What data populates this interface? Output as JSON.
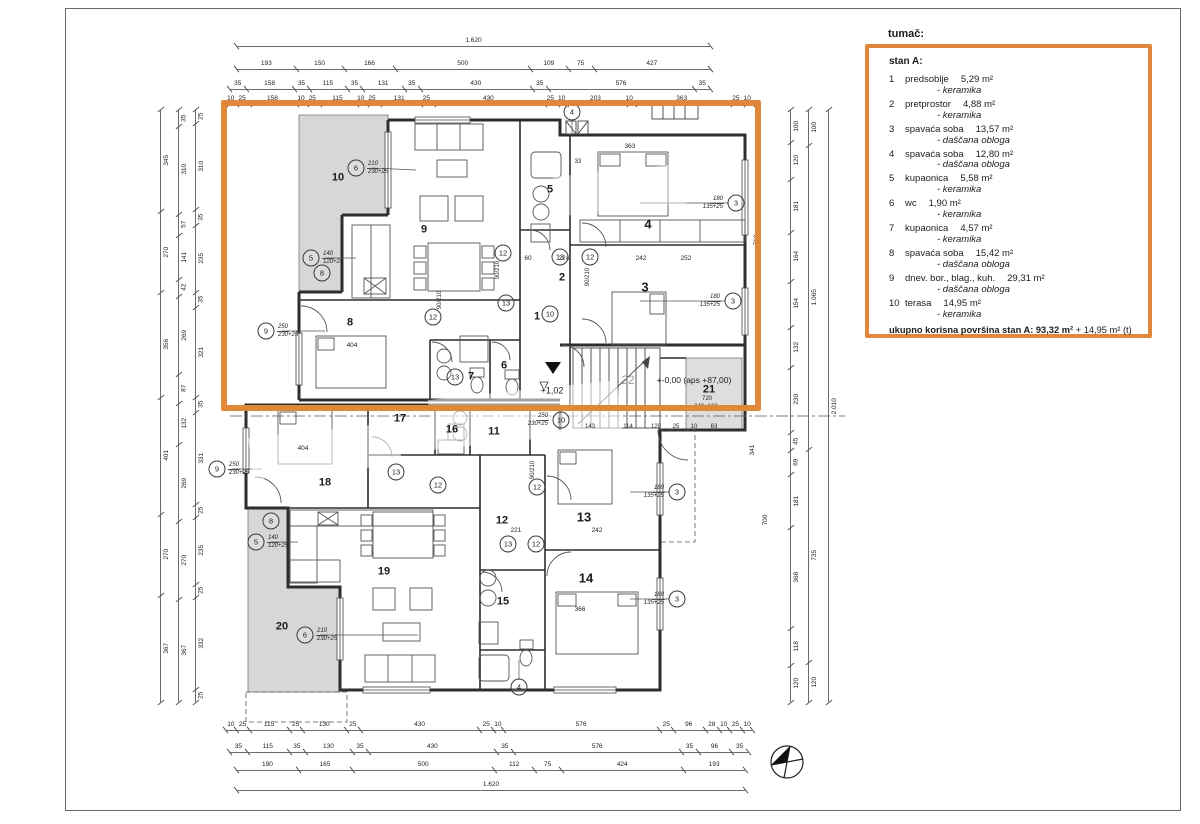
{
  "legend": {
    "title": "tumač:",
    "apartment": "stan A:",
    "items": [
      {
        "num": "1",
        "name": "predsoblje",
        "area": "5,29 m²",
        "material": "- keramika"
      },
      {
        "num": "2",
        "name": "pretprostor",
        "area": "4,88 m²",
        "material": "- keramika"
      },
      {
        "num": "3",
        "name": "spavaća soba",
        "area": "13,57 m²",
        "material": "- daščana obloga"
      },
      {
        "num": "4",
        "name": "spavaća soba",
        "area": "12,80 m²",
        "material": "- daščana obloga"
      },
      {
        "num": "5",
        "name": "kupaonica",
        "area": "5,58 m²",
        "material": "- keramika"
      },
      {
        "num": "6",
        "name": "wc",
        "area": "1,90 m²",
        "material": "- keramika"
      },
      {
        "num": "7",
        "name": "kupaonica",
        "area": "4,57 m²",
        "material": "- keramika"
      },
      {
        "num": "8",
        "name": "spavaća soba",
        "area": "15,42 m²",
        "material": "- daščana obloga"
      },
      {
        "num": "9",
        "name": "dnev. bor., blag., kuh.",
        "area": "29,31 m²",
        "material": "- daščana obloga"
      },
      {
        "num": "10",
        "name": "terasa",
        "area": "14,95 m²",
        "material": "- keramika"
      }
    ],
    "total_bold": "ukupno korisna površina stan A: 93,32 m²",
    "total_rest": " + 14,95 m² (t)"
  },
  "colors": {
    "highlight": "#e0873c",
    "wall": "#2e2e2e",
    "terrace_fill": "#d7d7d7"
  },
  "plan": {
    "dims": {
      "top1": [
        "1.620"
      ],
      "top2": [
        "193",
        "150",
        "166",
        "500",
        "109",
        "75",
        "427"
      ],
      "top3": [
        "35",
        "158",
        "35",
        "115",
        "35",
        "131",
        "35",
        "430",
        "35",
        "576",
        "35"
      ],
      "top4": [
        "10",
        "25",
        "158",
        "10",
        "25",
        "115",
        "10",
        "25",
        "131",
        "25",
        "430",
        "25",
        "10",
        "203",
        "10",
        "363",
        "25",
        "10"
      ],
      "bottom1": [
        "10",
        "25",
        "115",
        "25",
        "130",
        "25",
        "430",
        "25",
        "10",
        "576",
        "25",
        "96",
        "28",
        "10",
        "25",
        "10"
      ],
      "bottom2": [
        "35",
        "115",
        "35",
        "130",
        "35",
        "430",
        "35",
        "576",
        "35",
        "96",
        "35"
      ],
      "bottom3": [
        "190",
        "165",
        "500",
        "112",
        "75",
        "424",
        "193"
      ],
      "bottom4": [
        "1.620"
      ],
      "left1": [
        "345",
        "270",
        "356",
        "401",
        "270",
        "367"
      ],
      "left2": [
        "35",
        "310",
        "57",
        "141",
        "42",
        "269",
        "87",
        "132",
        "269",
        "270",
        "367"
      ],
      "left3": [
        "25",
        "310",
        "35",
        "235",
        "35",
        "321",
        "35",
        "331",
        "25",
        "235",
        "25",
        "332",
        "25"
      ],
      "right1": [
        "100",
        "120",
        "181",
        "164",
        "154",
        "132",
        "230",
        "45",
        "69",
        "181",
        "368",
        "118",
        "120"
      ],
      "right2": [
        "100",
        "1.065",
        "735",
        "120"
      ],
      "right3": [
        "2.010"
      ]
    },
    "labels": [
      {
        "t": "10",
        "x": 338,
        "y": 178,
        "s": 11,
        "b": 1
      },
      {
        "t": "9",
        "x": 424,
        "y": 230,
        "s": 11,
        "b": 1
      },
      {
        "t": "5",
        "x": 550,
        "y": 190,
        "s": 11,
        "b": 1
      },
      {
        "t": "4",
        "x": 648,
        "y": 224,
        "s": 13,
        "b": 1
      },
      {
        "t": "2",
        "x": 562,
        "y": 278,
        "s": 11,
        "b": 1
      },
      {
        "t": "3",
        "x": 645,
        "y": 287,
        "s": 13,
        "b": 1
      },
      {
        "t": "8",
        "x": 350,
        "y": 323,
        "s": 11,
        "b": 1
      },
      {
        "t": "1",
        "x": 537,
        "y": 317,
        "s": 11,
        "b": 1
      },
      {
        "t": "7",
        "x": 471,
        "y": 377,
        "s": 11,
        "b": 1
      },
      {
        "t": "6",
        "x": 504,
        "y": 366,
        "s": 11,
        "b": 1
      },
      {
        "t": "17",
        "x": 400,
        "y": 419,
        "s": 11,
        "b": 1
      },
      {
        "t": "16",
        "x": 452,
        "y": 430,
        "s": 11,
        "b": 1
      },
      {
        "t": "11",
        "x": 494,
        "y": 432,
        "s": 11,
        "b": 1
      },
      {
        "t": "18",
        "x": 325,
        "y": 483,
        "s": 11,
        "b": 1
      },
      {
        "t": "12",
        "x": 502,
        "y": 521,
        "s": 11,
        "b": 1
      },
      {
        "t": "13",
        "x": 584,
        "y": 517,
        "s": 13,
        "b": 1
      },
      {
        "t": "19",
        "x": 384,
        "y": 572,
        "s": 11,
        "b": 1
      },
      {
        "t": "15",
        "x": 503,
        "y": 602,
        "s": 11,
        "b": 1
      },
      {
        "t": "14",
        "x": 586,
        "y": 578,
        "s": 13,
        "b": 1
      },
      {
        "t": "20",
        "x": 282,
        "y": 627,
        "s": 11,
        "b": 1
      },
      {
        "t": "21",
        "x": 709,
        "y": 390,
        "s": 11,
        "b": 1
      },
      {
        "t": "22",
        "x": 628,
        "y": 380,
        "s": 12,
        "b": 0,
        "c": "#9a9a9a"
      },
      {
        "t": "+1,02",
        "x": 552,
        "y": 391,
        "s": 9,
        "b": 0
      },
      {
        "t": "+-0,00 (aps +87,00)",
        "x": 694,
        "y": 380,
        "s": 8.5,
        "b": 0
      },
      {
        "t": "720",
        "x": 707,
        "y": 399,
        "s": 6,
        "b": 0
      },
      {
        "t": "240+100",
        "x": 706,
        "y": 407,
        "s": 6,
        "b": 0
      },
      {
        "t": "143",
        "x": 590,
        "y": 427,
        "s": 6,
        "b": 0
      },
      {
        "t": "114",
        "x": 628,
        "y": 427,
        "s": 6,
        "b": 0
      },
      {
        "t": "120",
        "x": 656,
        "y": 427,
        "s": 6,
        "b": 0
      },
      {
        "t": "25",
        "x": 676,
        "y": 427,
        "s": 6,
        "b": 0
      },
      {
        "t": "10",
        "x": 694,
        "y": 427,
        "s": 6,
        "b": 0
      },
      {
        "t": "63",
        "x": 714,
        "y": 427,
        "s": 6,
        "b": 0
      },
      {
        "t": "363",
        "x": 630,
        "y": 147,
        "s": 6.5,
        "b": 0
      },
      {
        "t": "404",
        "x": 352,
        "y": 346,
        "s": 6.5,
        "b": 0
      },
      {
        "t": "404",
        "x": 303,
        "y": 449,
        "s": 6.5,
        "b": 0
      },
      {
        "t": "366",
        "x": 580,
        "y": 610,
        "s": 6.5,
        "b": 0
      },
      {
        "t": "242",
        "x": 641,
        "y": 259,
        "s": 6.5,
        "b": 0
      },
      {
        "t": "252",
        "x": 686,
        "y": 259,
        "s": 6.5,
        "b": 0
      },
      {
        "t": "60",
        "x": 528,
        "y": 259,
        "s": 6.5,
        "b": 0
      },
      {
        "t": "224",
        "x": 564,
        "y": 259,
        "s": 6.5,
        "b": 0
      },
      {
        "t": "221",
        "x": 516,
        "y": 531,
        "s": 6.5,
        "b": 0
      },
      {
        "t": "242",
        "x": 597,
        "y": 531,
        "s": 6.5,
        "b": 0
      },
      {
        "t": "90/210",
        "x": 498,
        "y": 270,
        "s": 6,
        "b": 0,
        "r": -90
      },
      {
        "t": "90/210",
        "x": 440,
        "y": 300,
        "s": 6,
        "b": 0,
        "r": -90
      },
      {
        "t": "90/210",
        "x": 533,
        "y": 470,
        "s": 6,
        "b": 0,
        "r": -90
      },
      {
        "t": "90/210",
        "x": 588,
        "y": 277,
        "s": 6,
        "b": 0,
        "r": -90
      },
      {
        "t": "33",
        "x": 578,
        "y": 162,
        "s": 6,
        "b": 0
      },
      {
        "t": "710",
        "x": 757,
        "y": 240,
        "s": 6.5,
        "b": 0,
        "r": -90
      },
      {
        "t": "341",
        "x": 753,
        "y": 450,
        "s": 6.5,
        "b": 0,
        "r": -90
      },
      {
        "t": "700",
        "x": 766,
        "y": 520,
        "s": 6.5,
        "b": 0,
        "r": -90
      }
    ],
    "tags": [
      {
        "n": "6",
        "x": 356,
        "y": 168,
        "d1": "210",
        "d2": "230+25",
        "side": "r"
      },
      {
        "n": "5",
        "x": 311,
        "y": 258,
        "d1": "140",
        "d2": "120+25",
        "side": "r"
      },
      {
        "n": "8",
        "x": 322,
        "y": 273
      },
      {
        "n": "9",
        "x": 266,
        "y": 331,
        "d1": "250",
        "d2": "230+25",
        "side": "r"
      },
      {
        "n": "3",
        "x": 736,
        "y": 203,
        "d1": "180",
        "d2": "135+25",
        "side": "l"
      },
      {
        "n": "3",
        "x": 733,
        "y": 301,
        "d1": "180",
        "d2": "135+25",
        "side": "l"
      },
      {
        "n": "4",
        "x": 572,
        "y": 112
      },
      {
        "n": "12",
        "x": 503,
        "y": 253
      },
      {
        "n": "13",
        "x": 560,
        "y": 257
      },
      {
        "n": "12",
        "x": 590,
        "y": 257
      },
      {
        "n": "12",
        "x": 433,
        "y": 317
      },
      {
        "n": "13",
        "x": 506,
        "y": 303
      },
      {
        "n": "10",
        "x": 550,
        "y": 314
      },
      {
        "n": "13",
        "x": 455,
        "y": 377
      },
      {
        "n": "9",
        "x": 217,
        "y": 469,
        "d1": "250",
        "d2": "230+25",
        "side": "r"
      },
      {
        "n": "5",
        "x": 256,
        "y": 542,
        "d1": "140",
        "d2": "120+25",
        "side": "r"
      },
      {
        "n": "8",
        "x": 271,
        "y": 521
      },
      {
        "n": "6",
        "x": 305,
        "y": 635,
        "d1": "210",
        "d2": "230+25",
        "side": "r"
      },
      {
        "n": "10",
        "x": 561,
        "y": 420,
        "d1": "250",
        "d2": "230+25",
        "side": "l"
      },
      {
        "n": "12",
        "x": 438,
        "y": 485
      },
      {
        "n": "13",
        "x": 396,
        "y": 472
      },
      {
        "n": "12",
        "x": 537,
        "y": 487
      },
      {
        "n": "13",
        "x": 508,
        "y": 544
      },
      {
        "n": "12",
        "x": 536,
        "y": 544
      },
      {
        "n": "3",
        "x": 677,
        "y": 492,
        "d1": "180",
        "d2": "135+25",
        "side": "l"
      },
      {
        "n": "3",
        "x": 677,
        "y": 599,
        "d1": "180",
        "d2": "135+25",
        "side": "l"
      },
      {
        "n": "4",
        "x": 519,
        "y": 687
      }
    ]
  }
}
